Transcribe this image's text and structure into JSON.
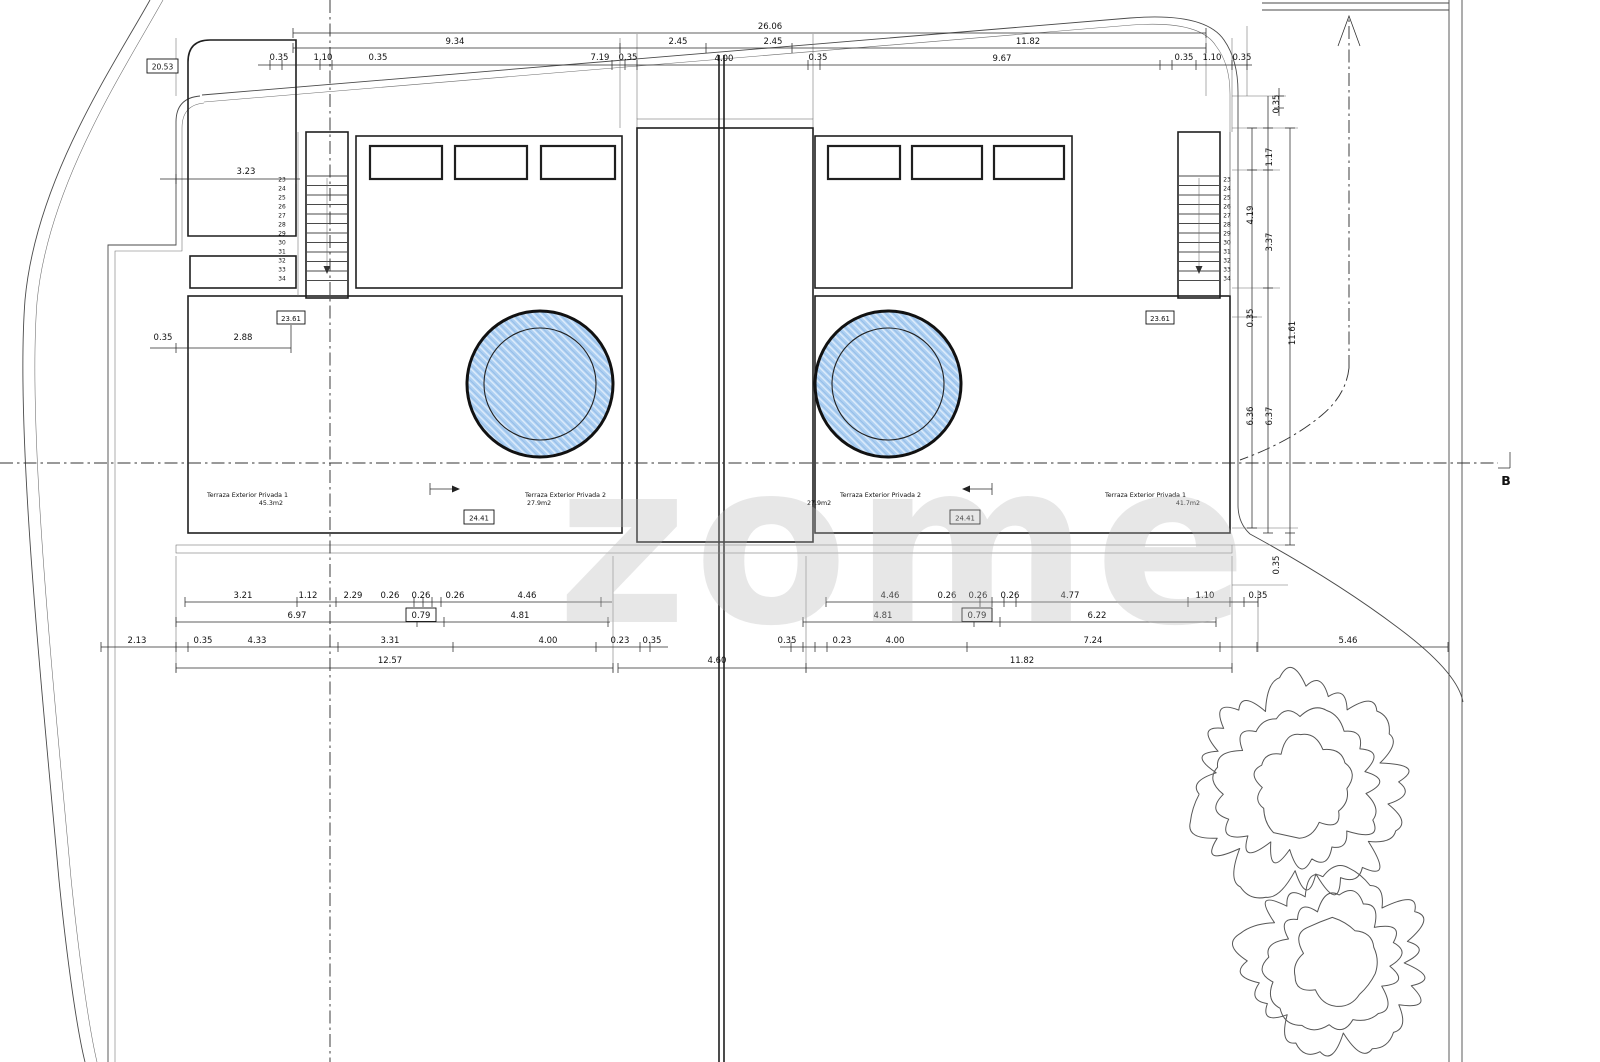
{
  "watermark": "zome",
  "section_marker": "B",
  "colors": {
    "garden_green": "#afa95e",
    "pool_blue": "#aecdf1",
    "line": "#1f1f1f"
  },
  "labels": {
    "boundary_length": "20.53",
    "terrace_left_1": "Terraza Exterior Privada 1",
    "terrace_left_1_area": "45.3m2",
    "terrace_left_2": "Terraza Exterior Privada 2",
    "terrace_left_2_area": "27.9m2",
    "terrace_right_2": "Terraza Exterior Privada 2",
    "terrace_right_2_area": "27.9m2",
    "terrace_right_1": "Terraza Exterior Privada 1",
    "terrace_right_1_area": "41.7m2",
    "level_left_deck": "23.61",
    "level_left_pool": "24.41",
    "level_right_pool": "24.41",
    "level_right_deck": "23.61"
  },
  "stairs": {
    "numbers": [
      "23",
      "24",
      "25",
      "26",
      "27",
      "28",
      "29",
      "30",
      "31",
      "32",
      "33",
      "34"
    ]
  },
  "dims": {
    "top": {
      "total": "26.06",
      "row1": [
        "9.34",
        "2.45",
        "2.45",
        "11.82"
      ],
      "row2": [
        "0.35",
        "1.10",
        "0.35",
        "7.19",
        "0.35",
        "4.00",
        "0.35",
        "9.67",
        "0.35",
        "1.10",
        "0.35"
      ]
    },
    "left": {
      "garden_width": "3.23",
      "offset": "0.35",
      "deck_start": "2.88"
    },
    "right": [
      "0.35",
      "1.17",
      "4.19",
      "3.37",
      "0.35",
      "11.61",
      "6.36",
      "6.37",
      "0.35"
    ],
    "bottom_left": {
      "row1": [
        "3.21",
        "1.12",
        "2.29",
        "0.26",
        "0.26",
        "0.26",
        "4.46"
      ],
      "row2": [
        "6.97",
        "0.79",
        "4.81"
      ],
      "row3": [
        "2.13",
        "0.35",
        "4.33",
        "3.31",
        "4.00",
        "0.23",
        "0.35"
      ],
      "total": "12.57"
    },
    "bottom_center": "4.60",
    "bottom_right": {
      "row1": [
        "4.46",
        "0.26",
        "0.26",
        "0.26",
        "4.77",
        "1.10",
        "0.35"
      ],
      "row2": [
        "4.81",
        "0.79",
        "6.22"
      ],
      "row3": [
        "0.35",
        "0.23",
        "4.00",
        "7.24",
        "5.46"
      ],
      "total": "11.82"
    }
  }
}
